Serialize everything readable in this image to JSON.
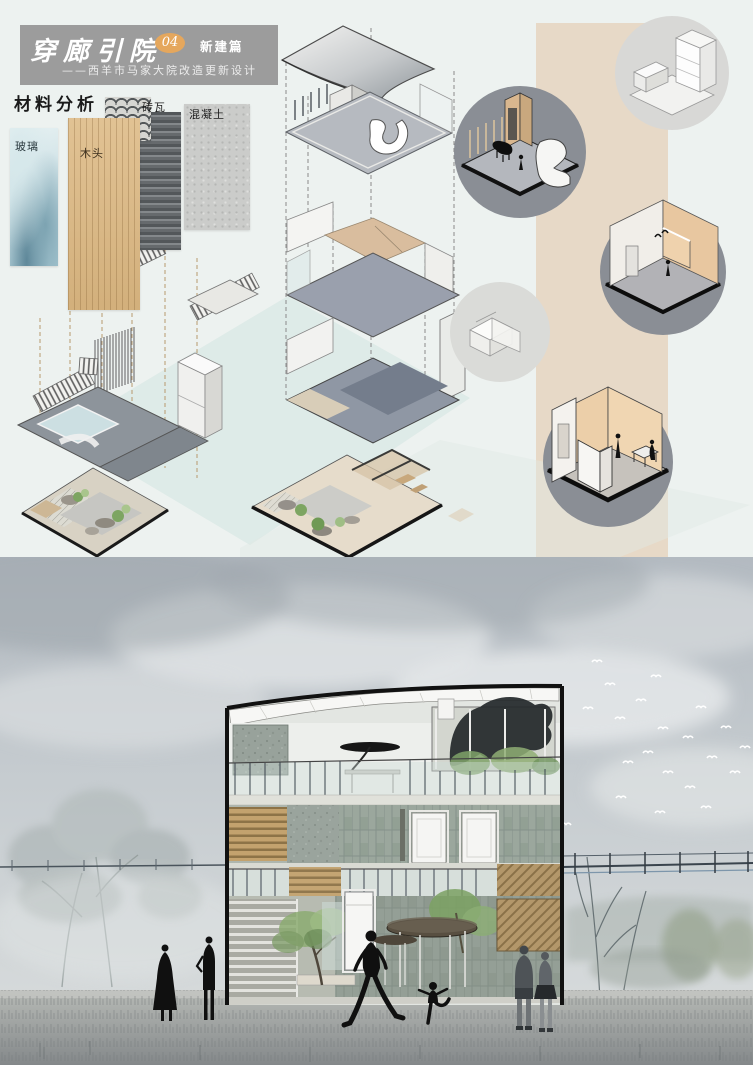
{
  "header": {
    "title": "穿廊引院",
    "number": "04",
    "badge": "新建篇",
    "subtitle": "——西羊市马家大院改造更新设计"
  },
  "materials": {
    "heading": "材料分析",
    "items": [
      {
        "id": "glass",
        "label": "玻璃"
      },
      {
        "id": "wood",
        "label": "木头"
      },
      {
        "id": "brick-tile",
        "label": "砖瓦"
      },
      {
        "id": "concrete",
        "label": "混凝土"
      }
    ]
  },
  "callouts": {
    "items": [
      {
        "id": "massing-model-top"
      },
      {
        "id": "interior-piano-room"
      },
      {
        "id": "massing-model-middle"
      },
      {
        "id": "interior-room-doors"
      },
      {
        "id": "interior-room-table"
      }
    ]
  },
  "colors": {
    "board_bg": "#edf2f0",
    "header_bg": "#9c9c9c",
    "accent_orange": "#e5a75d",
    "beige_band": "#e7d9c7",
    "callout_dark": "#8a8e95",
    "callout_light": "#d8d8d6",
    "room_tan": "#e8c7a0",
    "sky": "#c2c9cd",
    "ground": "#9b9f9d"
  }
}
